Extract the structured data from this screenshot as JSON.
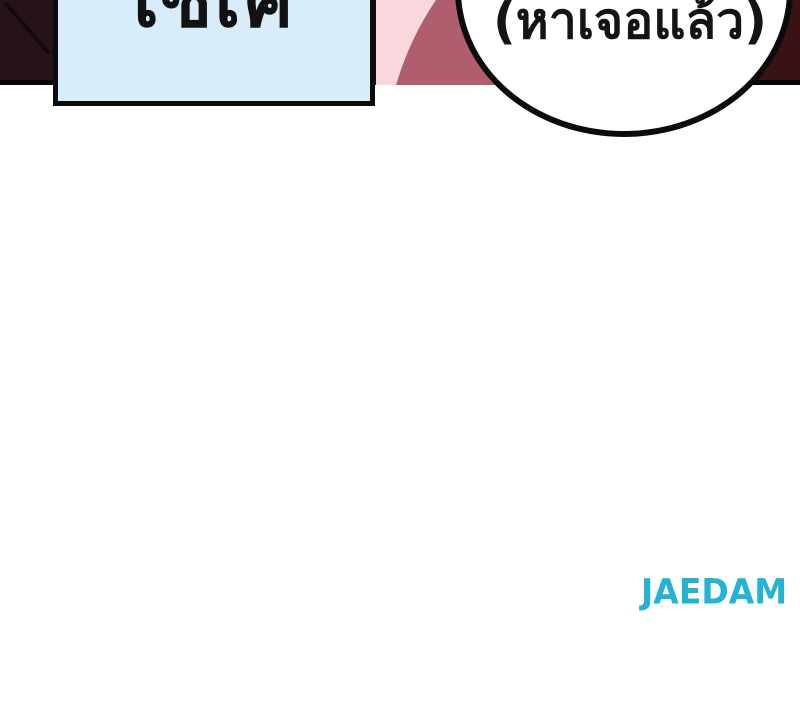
{
  "comic": {
    "panel": {
      "bg_left": "#251318",
      "bg_right": "#3a1216",
      "border_color": "#060606"
    },
    "caption_box": {
      "text": "เซเค",
      "bg_color": "#d8ecf9",
      "border_color": "#0c0c0c",
      "text_color": "#121212"
    },
    "speech_bubble": {
      "text": "(หาเจอแล้ว)",
      "bg_color": "#ffffff",
      "border_color": "#0b0b0b",
      "text_color": "#141414"
    },
    "character_art": {
      "skin_color": "#f8d8dc",
      "hair_color": "#b05e6d",
      "streak_color": "#150a0d"
    }
  },
  "footer": {
    "publisher_logo_text": "JAEDAM",
    "publisher_logo_color": "#25b3d5"
  }
}
